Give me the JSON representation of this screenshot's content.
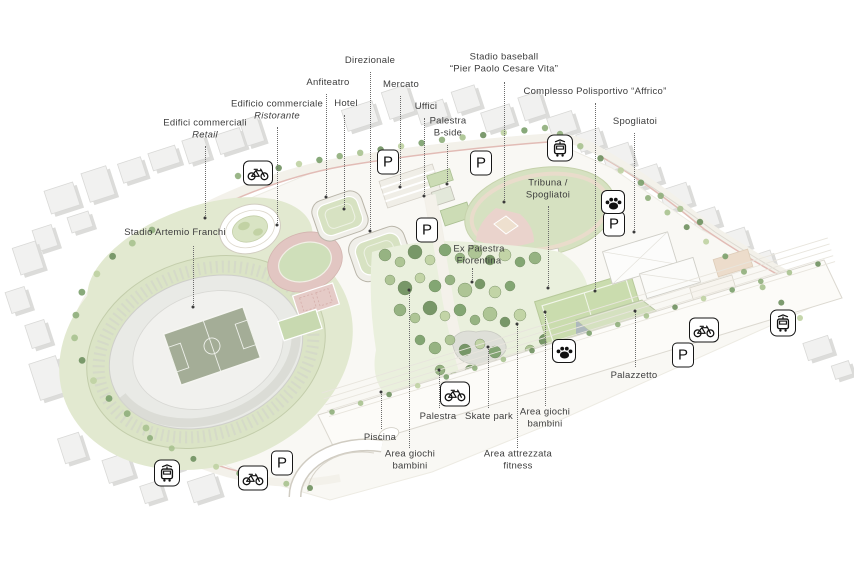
{
  "map": {
    "type": "axonometric-masterplan",
    "background": "#ffffff",
    "label_color": "#3d3d3d",
    "leader_color": "#6b6b6b",
    "badge_border_color": "#161616"
  },
  "callouts": [
    {
      "id": "edifici-commerciali-retail",
      "lines": [
        {
          "text": "Edifici commerciali",
          "italic": false
        },
        {
          "text": "Retail",
          "italic": true
        }
      ],
      "x": 205,
      "y": 130,
      "leader": {
        "x": 205,
        "y1": 146,
        "y2": 218,
        "dot_at": "bottom"
      }
    },
    {
      "id": "edificio-commerciale-ristorante",
      "lines": [
        {
          "text": "Edificio commerciale",
          "italic": false
        },
        {
          "text": "Ristorante",
          "italic": true
        }
      ],
      "x": 277,
      "y": 111,
      "leader": {
        "x": 277,
        "y1": 127,
        "y2": 225,
        "dot_at": "bottom"
      }
    },
    {
      "id": "anfiteatro",
      "lines": [
        {
          "text": "Anfiteatro",
          "italic": false
        }
      ],
      "x": 328,
      "y": 83,
      "leader": {
        "x": 326,
        "y1": 94,
        "y2": 197,
        "dot_at": "bottom"
      }
    },
    {
      "id": "hotel",
      "lines": [
        {
          "text": "Hotel",
          "italic": false
        }
      ],
      "x": 346,
      "y": 104,
      "leader": {
        "x": 344,
        "y1": 115,
        "y2": 209,
        "dot_at": "bottom"
      }
    },
    {
      "id": "direzionale",
      "lines": [
        {
          "text": "Direzionale",
          "italic": false
        }
      ],
      "x": 370,
      "y": 61,
      "leader": {
        "x": 370,
        "y1": 72,
        "y2": 231,
        "dot_at": "bottom"
      }
    },
    {
      "id": "mercato",
      "lines": [
        {
          "text": "Mercato",
          "italic": false
        }
      ],
      "x": 401,
      "y": 85,
      "leader": {
        "x": 400,
        "y1": 96,
        "y2": 187,
        "dot_at": "bottom"
      }
    },
    {
      "id": "uffici",
      "lines": [
        {
          "text": "Uffici",
          "italic": false
        }
      ],
      "x": 426,
      "y": 107,
      "leader": {
        "x": 424,
        "y1": 118,
        "y2": 196,
        "dot_at": "bottom"
      }
    },
    {
      "id": "palestra-b-side",
      "lines": [
        {
          "text": "Palestra",
          "italic": false
        },
        {
          "text": "B-side",
          "italic": false
        }
      ],
      "x": 448,
      "y": 128,
      "leader": {
        "x": 447,
        "y1": 145,
        "y2": 184,
        "dot_at": "bottom"
      }
    },
    {
      "id": "stadio-baseball",
      "lines": [
        {
          "text": "Stadio baseball",
          "italic": false
        },
        {
          "text": "“Pier Paolo Cesare Vita”",
          "italic": false
        }
      ],
      "x": 504,
      "y": 64,
      "leader": {
        "x": 504,
        "y1": 82,
        "y2": 202,
        "dot_at": "bottom"
      }
    },
    {
      "id": "complesso-polisportivo-affrico",
      "lines": [
        {
          "text": "Complesso Polisportivo “Affrico”",
          "italic": false
        }
      ],
      "x": 595,
      "y": 92,
      "leader": {
        "x": 595,
        "y1": 103,
        "y2": 291,
        "dot_at": "bottom"
      }
    },
    {
      "id": "spogliatoi",
      "lines": [
        {
          "text": "Spogliatoi",
          "italic": false
        }
      ],
      "x": 635,
      "y": 122,
      "leader": {
        "x": 634,
        "y1": 133,
        "y2": 232,
        "dot_at": "bottom"
      }
    },
    {
      "id": "tribuna-spogliatoi",
      "lines": [
        {
          "text": "Tribuna /",
          "italic": false
        },
        {
          "text": "Spogliatoi",
          "italic": false
        }
      ],
      "x": 548,
      "y": 190,
      "leader": {
        "x": 548,
        "y1": 206,
        "y2": 288,
        "dot_at": "bottom"
      }
    },
    {
      "id": "stadio-artemio-franchi",
      "lines": [
        {
          "text": "Stadio Artemio Franchi",
          "italic": false
        }
      ],
      "x": 175,
      "y": 233,
      "leader": {
        "x": 193,
        "y1": 246,
        "y2": 307,
        "dot_at": "bottom"
      }
    },
    {
      "id": "ex-palestra-fiorentina",
      "lines": [
        {
          "text": "Ex Palestra",
          "italic": false
        },
        {
          "text": "Fiorentina",
          "italic": false
        }
      ],
      "x": 479,
      "y": 256,
      "leader": {
        "x": 472,
        "y1": 268,
        "y2": 282,
        "dot_at": "bottom"
      }
    },
    {
      "id": "palazzetto",
      "lines": [
        {
          "text": "Palazzetto",
          "italic": false
        }
      ],
      "x": 634,
      "y": 376,
      "leader": {
        "x": 635,
        "y1": 311,
        "y2": 367,
        "dot_at": "top"
      }
    },
    {
      "id": "piscina",
      "lines": [
        {
          "text": "Piscina",
          "italic": false
        }
      ],
      "x": 380,
      "y": 438,
      "leader": {
        "x": 381,
        "y1": 392,
        "y2": 429,
        "dot_at": "top"
      }
    },
    {
      "id": "area-giochi-bambini-sw",
      "lines": [
        {
          "text": "Area giochi",
          "italic": false
        },
        {
          "text": "bambini",
          "italic": false
        }
      ],
      "x": 410,
      "y": 461,
      "leader": {
        "x": 409,
        "y1": 290,
        "y2": 448,
        "dot_at": "top"
      }
    },
    {
      "id": "palestra",
      "lines": [
        {
          "text": "Palestra",
          "italic": false
        }
      ],
      "x": 438,
      "y": 417,
      "leader": {
        "x": 439,
        "y1": 370,
        "y2": 408,
        "dot_at": "top"
      }
    },
    {
      "id": "skate-park",
      "lines": [
        {
          "text": "Skate park",
          "italic": false
        }
      ],
      "x": 489,
      "y": 417,
      "leader": {
        "x": 488,
        "y1": 347,
        "y2": 408,
        "dot_at": "top"
      }
    },
    {
      "id": "area-giochi-bambini-e",
      "lines": [
        {
          "text": "Area giochi",
          "italic": false
        },
        {
          "text": "bambini",
          "italic": false
        }
      ],
      "x": 545,
      "y": 419,
      "leader": {
        "x": 545,
        "y1": 312,
        "y2": 406,
        "dot_at": "top"
      }
    },
    {
      "id": "area-attrezzata-fitness",
      "lines": [
        {
          "text": "Area attrezzata",
          "italic": false
        },
        {
          "text": "fitness",
          "italic": false
        }
      ],
      "x": 518,
      "y": 461,
      "leader": {
        "x": 517,
        "y1": 324,
        "y2": 448,
        "dot_at": "top"
      }
    }
  ],
  "badges": [
    {
      "id": "parking-nw",
      "icon": "parking-icon",
      "label": "P",
      "x": 388,
      "y": 162
    },
    {
      "id": "parking-n",
      "icon": "parking-icon",
      "label": "P",
      "x": 481,
      "y": 163
    },
    {
      "id": "parking-center",
      "icon": "parking-icon",
      "label": "P",
      "x": 427,
      "y": 230
    },
    {
      "id": "parking-e",
      "icon": "parking-icon",
      "label": "P",
      "x": 614,
      "y": 224
    },
    {
      "id": "parking-se",
      "icon": "parking-icon",
      "label": "P",
      "x": 683,
      "y": 355
    },
    {
      "id": "parking-sw",
      "icon": "parking-icon",
      "label": "P",
      "x": 282,
      "y": 463
    },
    {
      "id": "bike-nw",
      "icon": "bike-icon",
      "x": 258,
      "y": 173
    },
    {
      "id": "bike-s",
      "icon": "bike-icon",
      "x": 455,
      "y": 394
    },
    {
      "id": "bike-e",
      "icon": "bike-icon",
      "x": 704,
      "y": 330
    },
    {
      "id": "bike-sw",
      "icon": "bike-icon",
      "x": 253,
      "y": 478
    },
    {
      "id": "tram-n",
      "icon": "tram-icon",
      "x": 560,
      "y": 148
    },
    {
      "id": "tram-e",
      "icon": "tram-icon",
      "x": 783,
      "y": 323
    },
    {
      "id": "tram-sw",
      "icon": "tram-icon",
      "x": 167,
      "y": 473
    },
    {
      "id": "paw-ne",
      "icon": "paw-icon",
      "x": 613,
      "y": 202
    },
    {
      "id": "paw-park",
      "icon": "paw-icon",
      "x": 564,
      "y": 351
    }
  ]
}
